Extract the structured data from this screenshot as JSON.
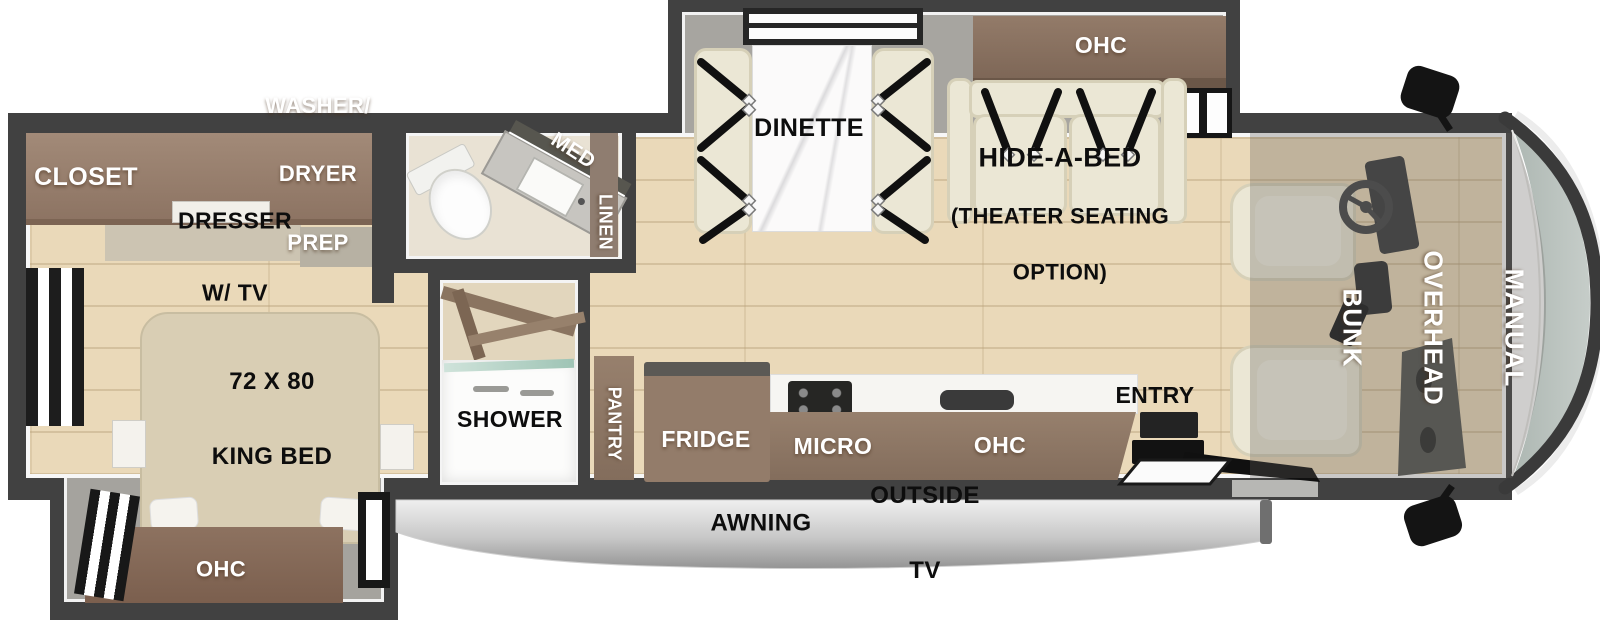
{
  "title": "RV floor plan - class A motorhome top view",
  "labels": {
    "closet": "CLOSET",
    "washer_dryer": [
      "WASHER/",
      "DRYER",
      "PREP"
    ],
    "dresser": [
      "DRESSER",
      "W/ TV"
    ],
    "king_bed": [
      "72 X 80",
      "KING BED"
    ],
    "bedroom_ohc": "OHC",
    "med": "MED",
    "linen": "LINEN",
    "shower": "SHOWER",
    "pantry": "PANTRY",
    "fridge": "FRIDGE",
    "micro": "MICRO",
    "kitchen_ohc": "OHC",
    "entry": "ENTRY",
    "dinette": "DINETTE",
    "living_ohc": "OHC",
    "hide_a_bed": [
      "HIDE-A-BED",
      "(THEATER SEATING",
      "OPTION)"
    ],
    "overhead_bunk": [
      "MANUAL",
      "OVERHEAD",
      "BUNK"
    ],
    "awning": "AWNING",
    "outside_tv": [
      "OUTSIDE",
      "TV"
    ]
  },
  "colors": {
    "wall": "#414141",
    "floor_wood": "#ead9b9",
    "cabinet_brown": "#8f7866",
    "cabinet_brown_light": "#a28a78",
    "cushion_cream": "#ebe7d5",
    "slide_interior_gray": "#a7a5a0",
    "windshield_glass": "#b7c0bb",
    "awning_light": "#ededed",
    "awning_dark": "#969696",
    "seatbelt_black": "#101010",
    "marble_white": "#f8f7f5"
  }
}
